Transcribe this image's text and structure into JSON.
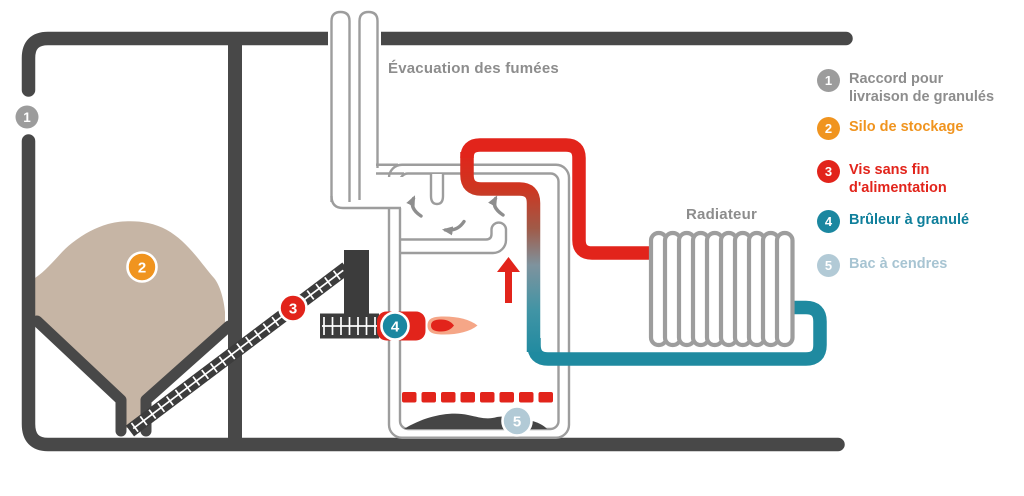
{
  "diagram": {
    "flue_label": "Évacuation des fumées",
    "radiator_label": "Radiateur",
    "markers": [
      "1",
      "2",
      "3",
      "4",
      "5"
    ]
  },
  "legend": {
    "items": [
      {
        "number": "1",
        "lines": [
          "Raccord pour",
          "livraison de granulés"
        ],
        "circle_color": "#9c9c9c",
        "text_color": "#8d8d8d"
      },
      {
        "number": "2",
        "lines": [
          "Silo de stockage"
        ],
        "circle_color": "#f0941f",
        "text_color": "#f0941f"
      },
      {
        "number": "3",
        "lines": [
          "Vis sans fin",
          "d'alimentation"
        ],
        "circle_color": "#e2241b",
        "text_color": "#e2241b"
      },
      {
        "number": "4",
        "lines": [
          "Brûleur à granulé"
        ],
        "circle_color": "#1b87a0",
        "text_color": "#0f7f9b"
      },
      {
        "number": "5",
        "lines": [
          "Bac à cendres"
        ],
        "circle_color": "#b2cad6",
        "text_color": "#a7c4d2"
      }
    ]
  },
  "colors": {
    "wall": "#484848",
    "auger": "#3c3c3c",
    "outline": "#9d9d9d",
    "red": "#e2241b",
    "teal": "#1f8aa0",
    "orange": "#f0941f",
    "lightblue": "#b2cad6",
    "pellets": "#c6b5a5",
    "text": "#8d8d8d",
    "arrow": "#8e8e8e",
    "ash": "#454545",
    "flame": "#f5a687",
    "marker_gray": "#9c9c9c"
  }
}
